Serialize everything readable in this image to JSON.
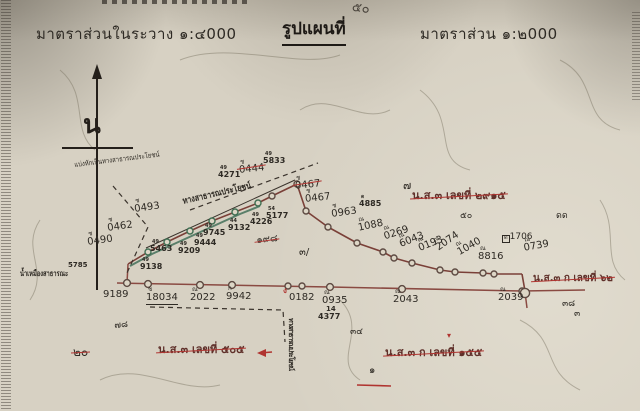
{
  "header": {
    "scale_left": "มาตราส่วนในระวาง ๑:๔000",
    "title": "รูปแผนที่",
    "scale_right": "มาตราส่วน ๑:๒000",
    "handwritten_note": "๕๐"
  },
  "compass": {
    "north_label": "น"
  },
  "palette": {
    "paper": "#d7d1c3",
    "ink": "#2e2a24",
    "red": "#b03430",
    "road_dark": "#7a4038",
    "road_red": "#8a4a42",
    "green": "#44715a"
  },
  "map": {
    "annotations": [
      {
        "n": "boundary-note",
        "t": "แบ่งหักเป็นทางสาธารณประโยชน์",
        "x": 74,
        "y": 162,
        "s": 7,
        "rot": -7,
        "scx": 0.85
      },
      {
        "n": "parcel-number",
        "sup": "ช",
        "t": "0493",
        "x": 133,
        "y": 199,
        "s": 10,
        "rot": -8
      },
      {
        "n": "parcel-number",
        "sup": "ช",
        "t": "0462",
        "x": 106,
        "y": 218,
        "s": 10,
        "rot": -8
      },
      {
        "n": "parcel-number",
        "sup": "ช",
        "t": "0490",
        "x": 86,
        "y": 232,
        "s": 10,
        "rot": -8
      },
      {
        "n": "parcel-number-crossed",
        "sup": "ช",
        "t": "0444",
        "x": 238,
        "y": 160,
        "s": 10,
        "rot": -6,
        "strike": 1
      },
      {
        "n": "marker-number",
        "sup": "49",
        "t": "5833",
        "x": 263,
        "y": 152,
        "s": 8,
        "b": 1
      },
      {
        "n": "marker-number",
        "sup": "49",
        "t": "4271",
        "x": 218,
        "y": 166,
        "s": 8,
        "b": 1
      },
      {
        "n": "road-stamp-label",
        "t": "ทางสาธารณประโยชน์",
        "x": 182,
        "y": 198,
        "s": 9,
        "b": 1,
        "rot": -13,
        "scx": 0.8
      },
      {
        "n": "parcel-number-crossed",
        "sup": "ช",
        "t": "0467",
        "x": 294,
        "y": 176,
        "s": 10,
        "rot": -6,
        "strike": 1
      },
      {
        "n": "parcel-number",
        "sup": "ช",
        "t": "0467",
        "x": 304,
        "y": 189,
        "s": 10,
        "rot": -6
      },
      {
        "n": "parcel-number",
        "sup": "ช",
        "t": "0963",
        "x": 330,
        "y": 204,
        "s": 10,
        "rot": -8
      },
      {
        "n": "marker-number",
        "sup": "ด",
        "t": "4885",
        "x": 359,
        "y": 195,
        "s": 8,
        "b": 1
      },
      {
        "n": "handwritten-mark",
        "t": "๗",
        "x": 403,
        "y": 180,
        "s": 11
      },
      {
        "n": "deed-ref-crossed",
        "t": "น.ส.๓ เลขที่ ๒๙๑๕",
        "x": 412,
        "y": 190,
        "s": 11,
        "strike": 1,
        "c": "#5f302a",
        "b": 1
      },
      {
        "n": "parcel-number",
        "sup": "ณ",
        "t": "1088",
        "x": 356,
        "y": 218,
        "s": 10,
        "rot": -12
      },
      {
        "n": "parcel-number",
        "sup": "ณ",
        "t": "0269",
        "x": 381,
        "y": 227,
        "s": 10,
        "rot": -18
      },
      {
        "n": "parcel-number",
        "sup": "ณ",
        "t": "6043",
        "x": 396,
        "y": 235,
        "s": 10,
        "rot": -22
      },
      {
        "n": "parcel-number",
        "sup": "ณ",
        "t": "0193",
        "x": 415,
        "y": 239,
        "s": 10,
        "rot": -22
      },
      {
        "n": "parcel-number",
        "sup": "ณ",
        "t": "2074",
        "x": 431,
        "y": 240,
        "s": 10,
        "rot": -35
      },
      {
        "n": "parcel-number",
        "sup": "ณ",
        "t": "1040",
        "x": 453,
        "y": 244,
        "s": 10,
        "rot": -30
      },
      {
        "n": "handwritten-mark",
        "t": "๕๐",
        "x": 460,
        "y": 212,
        "s": 9
      },
      {
        "n": "handwritten-mark",
        "t": "ดด",
        "x": 556,
        "y": 212,
        "s": 9
      },
      {
        "n": "parcel-number",
        "sup": "ณ",
        "t": "8816",
        "x": 478,
        "y": 246,
        "s": 10
      },
      {
        "n": "parcel-number",
        "sup": "ด",
        "t": "1706",
        "x": 500,
        "y": 233,
        "s": 9,
        "supbox": 1
      },
      {
        "n": "parcel-number",
        "sup": "ณ",
        "t": "0739",
        "x": 522,
        "y": 238,
        "s": 10,
        "rot": -10
      },
      {
        "n": "marker-number",
        "t": "5785",
        "x": 68,
        "y": 262,
        "s": 7,
        "b": 1
      },
      {
        "n": "marker-number",
        "sup": "49",
        "t": "9138",
        "x": 140,
        "y": 258,
        "s": 8,
        "b": 1
      },
      {
        "n": "marker-number",
        "sup": "49",
        "t": "5463",
        "x": 150,
        "y": 240,
        "s": 8,
        "b": 1
      },
      {
        "n": "marker-number",
        "sup": "49",
        "t": "9209",
        "x": 178,
        "y": 242,
        "s": 8,
        "b": 1
      },
      {
        "n": "marker-number",
        "sup": "49",
        "t": "9444",
        "x": 194,
        "y": 234,
        "s": 8,
        "b": 1
      },
      {
        "n": "marker-number",
        "sup": "49",
        "t": "9745",
        "x": 203,
        "y": 224,
        "s": 8,
        "b": 1
      },
      {
        "n": "marker-number",
        "sup": "44",
        "t": "9132",
        "x": 228,
        "y": 219,
        "s": 8,
        "b": 1
      },
      {
        "n": "marker-number",
        "sup": "49",
        "t": "4226",
        "x": 250,
        "y": 213,
        "s": 8,
        "b": 1
      },
      {
        "n": "marker-number",
        "sup": "54",
        "t": "5177",
        "x": 266,
        "y": 207,
        "s": 8,
        "b": 1
      },
      {
        "n": "canal-label",
        "t": "น้ำเหมืองสาธารณะ",
        "x": 20,
        "y": 270,
        "s": 8,
        "b": 1,
        "scx": 0.72
      },
      {
        "n": "handwritten-crossed",
        "t": "๑๙๘",
        "x": 256,
        "y": 236,
        "s": 10,
        "rot": -5,
        "strike": 1
      },
      {
        "n": "handwritten-mark",
        "t": "๓/",
        "x": 299,
        "y": 248,
        "s": 10
      },
      {
        "n": "distance-number",
        "t": "9189",
        "x": 103,
        "y": 290,
        "s": 10
      },
      {
        "n": "distance-number",
        "sup": "ช",
        "t": "18034",
        "x": 146,
        "y": 287,
        "s": 10,
        "u": 1
      },
      {
        "n": "distance-number",
        "sup": "ณ",
        "t": "2022",
        "x": 190,
        "y": 287,
        "s": 10
      },
      {
        "n": "distance-number",
        "sup": "ก",
        "t": "9942",
        "x": 226,
        "y": 286,
        "s": 10
      },
      {
        "n": "distance-number",
        "t": "0182",
        "x": 289,
        "y": 293,
        "s": 10
      },
      {
        "n": "red-check-mark",
        "t": "ง",
        "x": 283,
        "y": 287,
        "s": 8,
        "c": "#b03430",
        "b": 1
      },
      {
        "n": "distance-number",
        "sup": "ณ",
        "t": "0935",
        "x": 322,
        "y": 290,
        "s": 10
      },
      {
        "n": "marker-number",
        "t": "14",
        "x": 326,
        "y": 306,
        "s": 7,
        "b": 1
      },
      {
        "n": "marker-number",
        "t": "4377",
        "x": 318,
        "y": 313,
        "s": 8,
        "b": 1
      },
      {
        "n": "distance-number",
        "sup": "ณ",
        "t": "2043",
        "x": 393,
        "y": 289,
        "s": 10
      },
      {
        "n": "distance-number",
        "sup": "ณ",
        "t": "2039",
        "x": 498,
        "y": 287,
        "s": 10
      },
      {
        "n": "deed-ref-crossed",
        "t": "น.ส.๓ ก เลขที่ ๖๒",
        "x": 533,
        "y": 274,
        "s": 10,
        "strike": 1,
        "c": "#5f302a",
        "b": 1
      },
      {
        "n": "handwritten-mark",
        "t": "๓๘",
        "x": 562,
        "y": 300,
        "s": 9
      },
      {
        "n": "handwritten-mark",
        "t": "๓",
        "x": 574,
        "y": 310,
        "s": 9
      },
      {
        "n": "handwritten-mark",
        "t": "๗๘",
        "x": 114,
        "y": 322,
        "s": 9,
        "rot": -5
      },
      {
        "n": "handwritten-crossed",
        "t": "๒๐",
        "x": 73,
        "y": 346,
        "s": 12,
        "strike": 1
      },
      {
        "n": "deed-ref-crossed",
        "t": "น.ส.๓ เลขที่ ๕๐๕",
        "x": 158,
        "y": 344,
        "s": 11,
        "strike": 1,
        "c": "#5f302a",
        "b": 1
      },
      {
        "n": "vertical-stamp-label",
        "t": "ทางสาธารณประโยชน์",
        "x": 287,
        "y": 318,
        "s": 7,
        "b": 1,
        "vert": 1
      },
      {
        "n": "handwritten-mark",
        "t": "๓๔",
        "x": 350,
        "y": 328,
        "s": 9
      },
      {
        "n": "red-caret-mark",
        "t": "▾",
        "x": 447,
        "y": 332,
        "s": 8,
        "c": "#b03430"
      },
      {
        "n": "deed-ref-crossed",
        "t": "น.ส.๓ ก เลขที่ ๑๕๕",
        "x": 385,
        "y": 347,
        "s": 11,
        "strike": 1,
        "c": "#5f302a",
        "b": 1
      },
      {
        "n": "handwritten-mark",
        "t": "๑",
        "x": 369,
        "y": 366,
        "s": 10
      }
    ],
    "lines": [
      {
        "name": "bottom-boundary-line",
        "cls": "road2",
        "pts": [
          [
            117,
            283
          ],
          [
            330,
            287
          ],
          [
            522,
            291
          ],
          [
            585,
            290
          ]
        ]
      },
      {
        "name": "bottom-left-connector",
        "cls": "road2",
        "pts": [
          [
            127,
            283
          ],
          [
            128,
            264
          ]
        ]
      },
      {
        "name": "upper-road-ascending",
        "cls": "road",
        "pts": [
          [
            128,
            264
          ],
          [
            148,
            252
          ],
          [
            167,
            242
          ],
          [
            190,
            231
          ],
          [
            212,
            221
          ],
          [
            235,
            212
          ],
          [
            258,
            203
          ],
          [
            272,
            196
          ],
          [
            297,
            184
          ]
        ]
      },
      {
        "name": "upper-road-descending",
        "cls": "road",
        "pts": [
          [
            297,
            184
          ],
          [
            306,
            211
          ],
          [
            328,
            227
          ],
          [
            357,
            243
          ],
          [
            383,
            252
          ],
          [
            394,
            258
          ],
          [
            412,
            263
          ],
          [
            440,
            270
          ],
          [
            455,
            272
          ],
          [
            483,
            273
          ],
          [
            494,
            274
          ],
          [
            522,
            274
          ]
        ]
      },
      {
        "name": "road-junction-drop",
        "cls": "road",
        "pts": [
          [
            522,
            274
          ],
          [
            525,
            291
          ]
        ]
      },
      {
        "name": "junction-tail",
        "cls": "road2",
        "pts": [
          [
            525,
            292
          ],
          [
            527,
            308
          ]
        ]
      },
      {
        "name": "road-edge-black",
        "cls": "blackline",
        "pts": [
          [
            146,
            248
          ],
          [
            295,
            180
          ]
        ]
      },
      {
        "name": "green-road-line",
        "cls": "green",
        "pts": [
          [
            130,
            266
          ],
          [
            152,
            254
          ],
          [
            174,
            244
          ],
          [
            196,
            234
          ],
          [
            218,
            224
          ],
          [
            240,
            214
          ],
          [
            260,
            206
          ]
        ]
      },
      {
        "name": "dashed-boundary-left",
        "cls": "dash",
        "pts": [
          [
            113,
            186
          ],
          [
            148,
            227
          ],
          [
            127,
            273
          ]
        ]
      },
      {
        "name": "dashed-boundary-upper",
        "cls": "dash",
        "pts": [
          [
            190,
            210
          ],
          [
            318,
            163
          ]
        ]
      },
      {
        "name": "dashed-boundary-bottom",
        "cls": "dash",
        "pts": [
          [
            150,
            307
          ],
          [
            283,
            310
          ],
          [
            285,
            342
          ]
        ]
      },
      {
        "name": "red-underline",
        "cls": "redu",
        "pts": [
          [
            357,
            385
          ],
          [
            391,
            386
          ]
        ]
      },
      {
        "name": "red-arrow-line",
        "cls": "redu",
        "pts": [
          [
            272,
            352
          ],
          [
            260,
            353
          ]
        ]
      }
    ],
    "circles": [
      [
        148,
        252,
        3,
        "marker g"
      ],
      [
        167,
        242,
        3,
        "marker g"
      ],
      [
        190,
        231,
        3,
        "marker g"
      ],
      [
        212,
        221,
        3,
        "marker g"
      ],
      [
        235,
        212,
        3,
        "marker g"
      ],
      [
        258,
        203,
        3,
        "marker g"
      ],
      [
        272,
        196,
        3,
        "marker"
      ],
      [
        297,
        184,
        3,
        "marker"
      ],
      [
        306,
        211,
        3,
        "marker"
      ],
      [
        328,
        227,
        3,
        "marker"
      ],
      [
        357,
        243,
        3,
        "marker"
      ],
      [
        383,
        252,
        3,
        "marker"
      ],
      [
        394,
        258,
        3,
        "marker"
      ],
      [
        412,
        263,
        3,
        "marker"
      ],
      [
        440,
        270,
        3,
        "marker"
      ],
      [
        455,
        272,
        3,
        "marker"
      ],
      [
        483,
        273,
        3,
        "marker"
      ],
      [
        494,
        274,
        3,
        "marker"
      ],
      [
        127,
        283,
        3.4,
        "marker"
      ],
      [
        148,
        284,
        3.4,
        "marker"
      ],
      [
        200,
        285,
        3.4,
        "marker"
      ],
      [
        232,
        285,
        3.4,
        "marker"
      ],
      [
        288,
        286,
        3,
        "marker"
      ],
      [
        302,
        286,
        3,
        "marker"
      ],
      [
        330,
        287,
        3.4,
        "marker"
      ],
      [
        402,
        289,
        3.4,
        "marker"
      ],
      [
        522,
        291,
        3,
        "marker"
      ],
      [
        525,
        293,
        4.6,
        "marker"
      ]
    ]
  }
}
